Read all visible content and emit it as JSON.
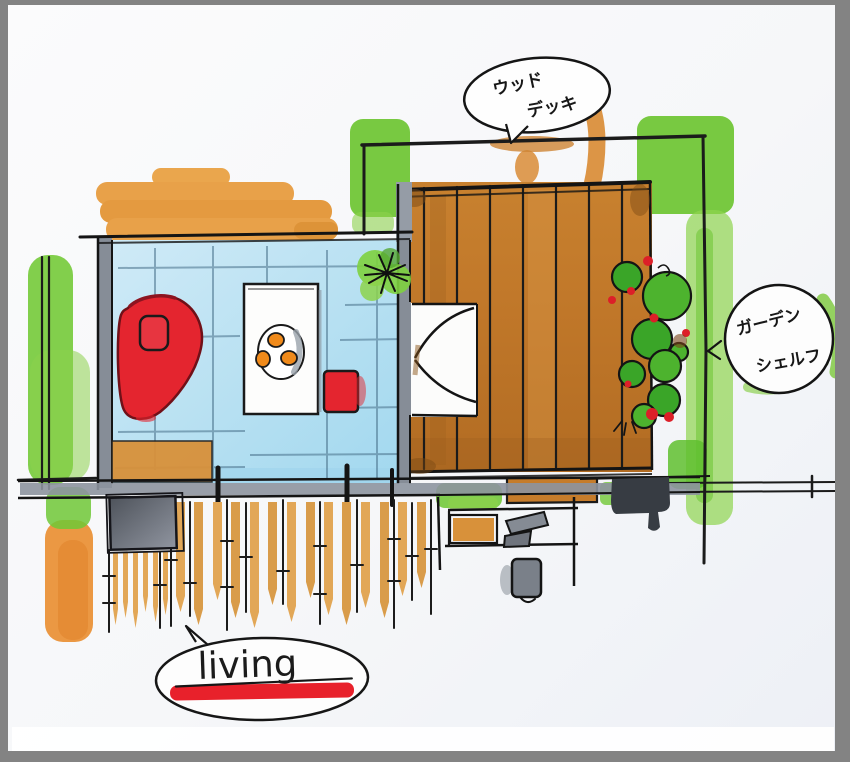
{
  "sketch": {
    "type": "hand-drawn floor plan (marker sketch)",
    "labels": {
      "wood_deck": {
        "line1": "ウッド",
        "line2": "デッキ"
      },
      "garden_shelf": {
        "line1": "ガーデン",
        "line2": "シェルフ"
      },
      "room": {
        "name": "living"
      }
    },
    "palette": {
      "paper": "#f6f7f9",
      "frame_gray": "#838383",
      "marker_orange": "#e8a149",
      "deck_brown": "#c27b2d",
      "grass_green": "#6cc431",
      "bush_green": "#3aa528",
      "accent_red": "#e4252f",
      "floor_blue": "#b9e1f2",
      "furniture_gray": "#7a8089",
      "ink": "#1b1b1b"
    }
  }
}
